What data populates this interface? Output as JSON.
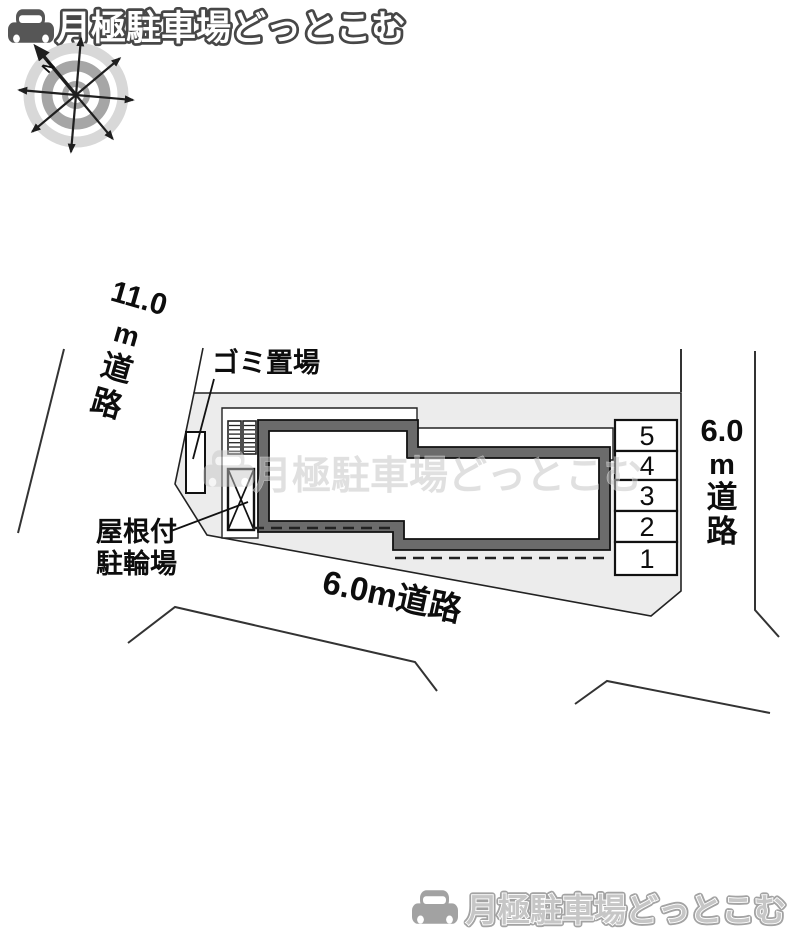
{
  "branding": {
    "logo_text": "月極駐車場どっとこむ",
    "footer_logo_text": "月極駐車場どっとこむ"
  },
  "watermark": {
    "text": "月極駐車場どっとこむ"
  },
  "compass": {
    "north_label": "N"
  },
  "site_plan": {
    "roads": {
      "left": {
        "number": "11.0",
        "unit": "m",
        "char1": "道",
        "char2": "路"
      },
      "right": {
        "number": "6.0",
        "unit": "m",
        "char1": "道",
        "char2": "路"
      },
      "bottom": {
        "label": "6.0m道路"
      }
    },
    "labels": {
      "garbage": "ゴミ置場",
      "bicycle_parking_line1": "屋根付",
      "bicycle_parking_line2": "駐輪場"
    },
    "parking": {
      "spaces": [
        "5",
        "4",
        "3",
        "2",
        "1"
      ]
    }
  },
  "colors": {
    "parcel_fill": "#ececec",
    "building_border": "#6b6b6b",
    "watermark_gray": "#c7c7c7",
    "logo_outline": "#474747",
    "footer_gray": "#c6c6c6"
  }
}
